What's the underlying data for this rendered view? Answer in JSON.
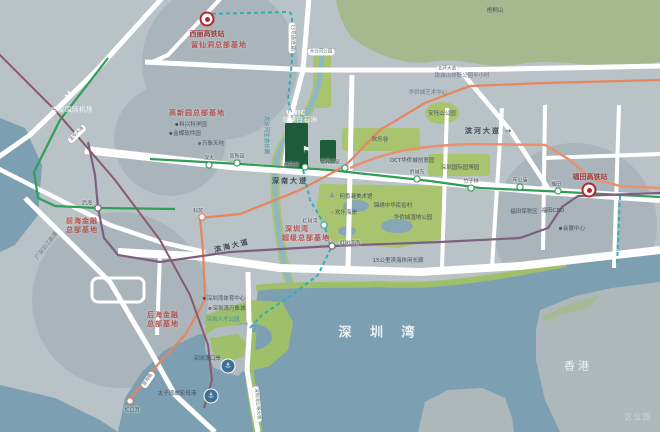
{
  "watermark": "区位图",
  "colors": {
    "land": "#b9c2c6",
    "water": "#7d9fb2",
    "park": "#a8c46f",
    "mountain": "#a4ba8e",
    "road": "#ffffff",
    "green": "#2f9e57",
    "orange": "#e8855f",
    "purple": "#7d6080",
    "teal": "#2fb0b4",
    "maroon": "#8a5a6a",
    "hq_red": "#b5504d",
    "project_green": "#1d5c38"
  },
  "project": {
    "line1": "UNIC",
    "line2": "绿景白石洲"
  },
  "labels": [
    {
      "text": "西丽高铁站",
      "x": 207,
      "y": 34,
      "cls": "station-name-red"
    },
    {
      "text": "留仙洞总部基地",
      "x": 219,
      "y": 45,
      "cls": "hq"
    },
    {
      "text": "高新园总部基地",
      "x": 197,
      "y": 113,
      "cls": "hq"
    },
    {
      "text": "深圳湾",
      "x": 297,
      "y": 229,
      "cls": "hq"
    },
    {
      "text": "超级总部基地",
      "x": 306,
      "y": 238,
      "cls": "hq"
    },
    {
      "text": "后海金融",
      "x": 163,
      "y": 315,
      "cls": "hq"
    },
    {
      "text": "总部基地",
      "x": 163,
      "y": 324,
      "cls": "hq"
    },
    {
      "text": "前海金融",
      "x": 82,
      "y": 221,
      "cls": "hq"
    },
    {
      "text": "总部基地",
      "x": 82,
      "y": 230,
      "cls": "hq"
    },
    {
      "text": "宝安国际机场",
      "x": 72,
      "y": 110,
      "cls": "white-sm"
    },
    {
      "text": "深南大道",
      "x": 290,
      "y": 181,
      "cls": "road-dark"
    },
    {
      "text": "滨海大道",
      "x": 232,
      "y": 246,
      "cls": "road-dark",
      "rot": -14
    },
    {
      "text": "滨河大道 →",
      "x": 489,
      "y": 131,
      "cls": "road-dark"
    },
    {
      "text": "梧桐山",
      "x": 495,
      "y": 11,
      "cls": "dark-xs"
    },
    {
      "text": "银湖山郊野公园半小时",
      "x": 462,
      "y": 76,
      "cls": "gray-xs"
    },
    {
      "text": "华侨城艺术中心",
      "x": 428,
      "y": 93,
      "cls": "gray-xs"
    },
    {
      "text": "安托山公园",
      "x": 442,
      "y": 114,
      "cls": "dark-xs"
    },
    {
      "text": "深圳国际园博园",
      "x": 460,
      "y": 168,
      "cls": "dark-xs"
    },
    {
      "text": "OCT华侨城创意园",
      "x": 412,
      "y": 161,
      "cls": "dark-xs"
    },
    {
      "text": "欢乐谷",
      "x": 380,
      "y": 140,
      "cls": "dark-xs"
    },
    {
      "text": "何香凝美术馆",
      "x": 356,
      "y": 197,
      "cls": "dark-xs"
    },
    {
      "text": "锦绣中华民俗村",
      "x": 393,
      "y": 206,
      "cls": "dark-xs"
    },
    {
      "text": "欢乐海岸",
      "x": 344,
      "y": 213,
      "cls": "dark-xs",
      "dot": "#e8855f"
    },
    {
      "text": "华侨城湿地公园",
      "x": 413,
      "y": 218,
      "cls": "dark-xs"
    },
    {
      "text": "福田保税区",
      "x": 524,
      "y": 212,
      "cls": "dark-xs"
    },
    {
      "text": "15公里滨海休闲长廊",
      "x": 398,
      "y": 261,
      "cls": "dark-xs"
    },
    {
      "text": "福田CBD",
      "x": 553,
      "y": 211,
      "cls": "dark-xs"
    },
    {
      "text": "会展中心",
      "x": 572,
      "y": 229,
      "cls": "dark-xs",
      "dot": "#47525c"
    },
    {
      "text": "福田高铁站",
      "x": 590,
      "y": 177,
      "cls": "station-name-red"
    },
    {
      "text": "深圳湾体育中心",
      "x": 224,
      "y": 299,
      "cls": "dark-xs",
      "dot": "#47525c"
    },
    {
      "text": "深圳湾万象城",
      "x": 227,
      "y": 309,
      "cls": "dark-xs",
      "dot": "#7d6080"
    },
    {
      "text": "深圳人才公园",
      "x": 223,
      "y": 320,
      "cls": "teal-xs"
    },
    {
      "text": "深圳湾口岸",
      "x": 207,
      "y": 359,
      "cls": "dark-xs"
    },
    {
      "text": "太子湾邮轮母港",
      "x": 177,
      "y": 394,
      "cls": "dark-xs"
    },
    {
      "text": "深 圳 湾",
      "x": 380,
      "y": 334,
      "cls": "bay"
    },
    {
      "text": "香港",
      "x": 578,
      "y": 367,
      "cls": "hk"
    },
    {
      "text": "区位图",
      "x": 638,
      "y": 417,
      "cls": "watermark"
    },
    {
      "text": "科兴科学园",
      "x": 191,
      "y": 125,
      "cls": "dark-xs",
      "dot": "#47525c"
    },
    {
      "text": "金蝶软件园",
      "x": 185,
      "y": 134,
      "cls": "dark-xs",
      "dot": "#47525c"
    },
    {
      "text": "万象天地",
      "x": 211,
      "y": 144,
      "cls": "dark-xs",
      "dot": "#7d6080"
    },
    {
      "text": "大沙河生态长廊",
      "x": 266,
      "y": 135,
      "cls": "teal-xs",
      "rot": 90
    },
    {
      "text": "大沙河公园",
      "x": 321,
      "y": 52,
      "cls": "pill"
    },
    {
      "text": "13号线(在建)",
      "x": 292,
      "y": 38,
      "cls": "pill",
      "rot": 90
    },
    {
      "text": "北环大道",
      "x": 447,
      "y": 69,
      "cls": "pill"
    },
    {
      "text": "望海路",
      "x": 148,
      "y": 380,
      "cls": "pill",
      "rot": -55
    },
    {
      "text": "深圳湾公路大桥",
      "x": 257,
      "y": 404,
      "cls": "pill",
      "rot": 85
    },
    {
      "text": "宝安大道",
      "x": 77,
      "y": 134,
      "cls": "pill",
      "rot": -45
    },
    {
      "text": "广深沿江高速",
      "x": 47,
      "y": 246,
      "cls": "gray-xs",
      "rot": -52
    }
  ],
  "stations": [
    {
      "name": "深大",
      "x": 209,
      "y": 165,
      "line": "green",
      "lx": 209,
      "ly": 158
    },
    {
      "name": "高新园",
      "x": 237,
      "y": 163,
      "line": "green",
      "lx": 237,
      "ly": 156
    },
    {
      "name": "白石洲",
      "x": 305,
      "y": 167,
      "line": "green",
      "lx": 291,
      "ly": 165
    },
    {
      "name": "世界之窗",
      "x": 345,
      "y": 168,
      "line": "green",
      "lx": 330,
      "ly": 162
    },
    {
      "name": "侨城东",
      "x": 417,
      "y": 179,
      "line": "green",
      "lx": 417,
      "ly": 172
    },
    {
      "name": "竹子林",
      "x": 471,
      "y": 188,
      "line": "green",
      "lx": 471,
      "ly": 181
    },
    {
      "name": "车公庙",
      "x": 520,
      "y": 187,
      "line": "green",
      "lx": 520,
      "ly": 180
    },
    {
      "name": "福田",
      "x": 558,
      "y": 191,
      "line": "green",
      "lx": 556,
      "ly": 184
    },
    {
      "name": "科苑",
      "x": 202,
      "y": 217,
      "line": "orange",
      "lx": 198,
      "ly": 211
    },
    {
      "name": "后海",
      "x": 98,
      "y": 208,
      "line": "purple",
      "lx": 87,
      "ly": 203
    },
    {
      "name": "红树湾",
      "x": 324,
      "y": 225,
      "line": "teal",
      "lx": 310,
      "ly": 221
    },
    {
      "name": "红树湾南",
      "x": 332,
      "y": 246,
      "line": "purple",
      "lx": 350,
      "ly": 243
    },
    {
      "name": "蛇口港",
      "x": 130,
      "y": 401,
      "line": "orange",
      "lx": 132,
      "ly": 410
    }
  ],
  "icons": [
    {
      "name": "hsr-icon",
      "x": 207,
      "y": 19
    },
    {
      "name": "hsr-icon",
      "x": 589,
      "y": 190
    },
    {
      "name": "plane-icon",
      "x": 70,
      "y": 96
    },
    {
      "name": "port-icon",
      "x": 228,
      "y": 366
    },
    {
      "name": "port-icon",
      "x": 211,
      "y": 396
    },
    {
      "name": "flag-icon",
      "x": 306,
      "y": 147
    },
    {
      "name": "pavilion-icon",
      "x": 332,
      "y": 191
    }
  ]
}
